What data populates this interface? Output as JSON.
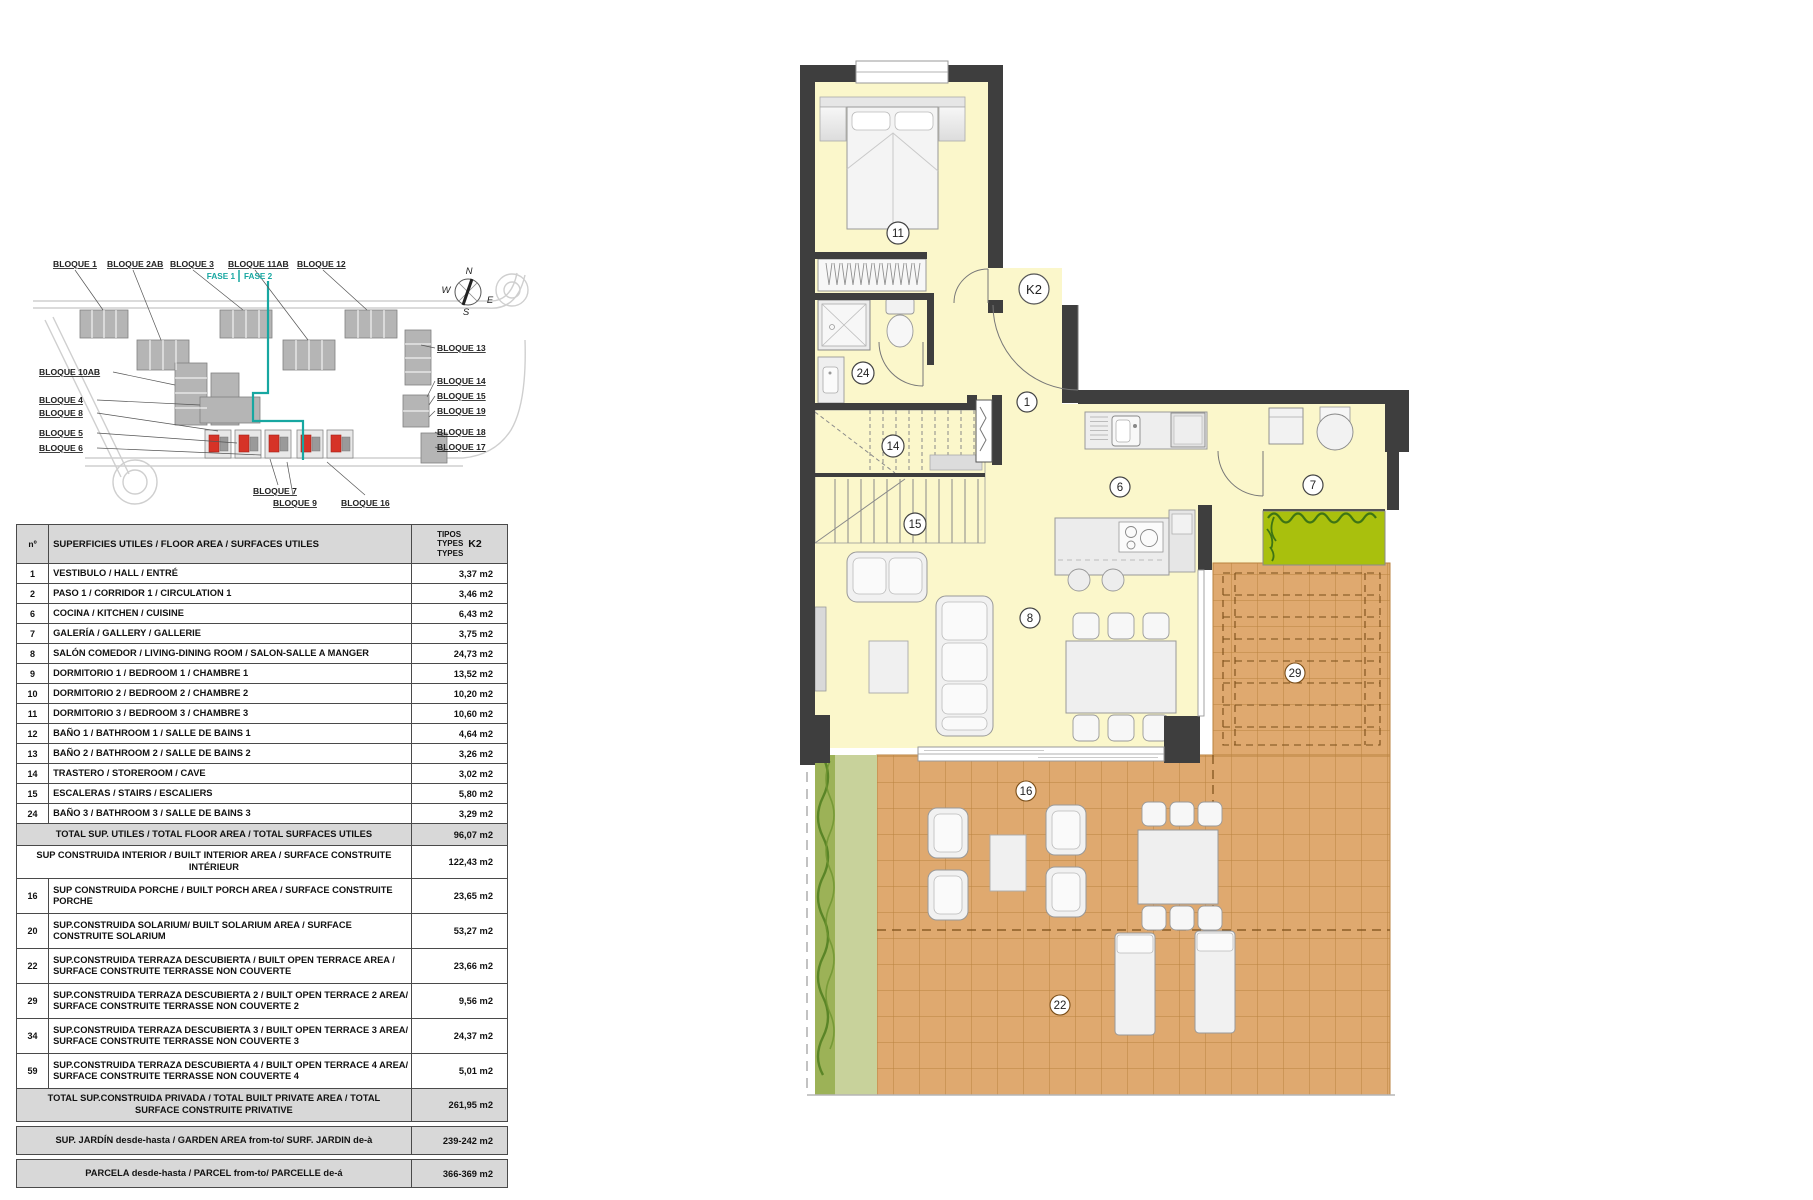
{
  "document": {
    "background": "#ffffff"
  },
  "site_plan": {
    "labels_top": [
      "BLOQUE 1",
      "BLOQUE 2AB",
      "BLOQUE 3",
      "BLOQUE 11AB",
      "BLOQUE 12"
    ],
    "fase1": "FASE 1",
    "fase2": "FASE 2",
    "labels_left": [
      "BLOQUE 10AB",
      "BLOQUE 4",
      "BLOQUE 8",
      "BLOQUE 5",
      "BLOQUE 6"
    ],
    "labels_right": [
      "BLOQUE 13",
      "BLOQUE 14",
      "BLOQUE 15",
      "BLOQUE 19",
      "BLOQUE 18",
      "BLOQUE 17"
    ],
    "labels_bottom": [
      "BLOQUE 7",
      "BLOQUE 9",
      "BLOQUE 16"
    ],
    "compass": {
      "n": "N",
      "s": "S",
      "e": "E",
      "w": "W"
    },
    "colors": {
      "phase_line": "#17a7a1",
      "highlight_unit": "#d63327",
      "building": "#b5b5b5"
    }
  },
  "area_table": {
    "header": {
      "num_col": "nº",
      "label_col": "SUPERFICIES UTILES / FLOOR AREA / SURFACES UTILES",
      "types_line1": "TIPOS",
      "types_line2": "TYPES",
      "types_line3": "TYPES",
      "type_code": "K2"
    },
    "rows": [
      {
        "num": "1",
        "label": "VESTIBULO / HALL / ENTRÉ",
        "value": "3,37 m2"
      },
      {
        "num": "2",
        "label": "PASO 1 / CORRIDOR 1 / CIRCULATION 1",
        "value": "3,46 m2"
      },
      {
        "num": "6",
        "label": "COCINA / KITCHEN / CUISINE",
        "value": "6,43 m2"
      },
      {
        "num": "7",
        "label": "GALERÍA / GALLERY / GALLERIE",
        "value": "3,75 m2"
      },
      {
        "num": "8",
        "label": "SALÓN COMEDOR  / LIVING-DINING ROOM / SALON-SALLE A MANGER",
        "value": "24,73 m2"
      },
      {
        "num": "9",
        "label": "DORMITORIO 1 / BEDROOM 1 / CHAMBRE 1",
        "value": "13,52 m2"
      },
      {
        "num": "10",
        "label": "DORMITORIO 2 / BEDROOM 2 / CHAMBRE 2",
        "value": "10,20 m2"
      },
      {
        "num": "11",
        "label": "DORMITORIO 3 / BEDROOM 3 / CHAMBRE 3",
        "value": "10,60 m2"
      },
      {
        "num": "12",
        "label": "BAÑO 1 / BATHROOM 1 / SALLE DE BAINS 1",
        "value": "4,64 m2"
      },
      {
        "num": "13",
        "label": "BAÑO 2 / BATHROOM 2 / SALLE DE BAINS 2",
        "value": "3,26 m2"
      },
      {
        "num": "14",
        "label": "TRASTERO / STOREROOM / CAVE",
        "value": "3,02 m2"
      },
      {
        "num": "15",
        "label": "ESCALERAS / STAIRS / ESCALIERS",
        "value": "5,80 m2"
      },
      {
        "num": "24",
        "label": "BAÑO 3 / BATHROOM 3 / SALLE DE BAINS 3",
        "value": "3,29 m2"
      }
    ],
    "total_utiles": {
      "label": "TOTAL  SUP. UTILES / TOTAL FLOOR AREA / TOTAL  SURFACES UTILES",
      "value": "96,07 m2"
    },
    "built_rows": [
      {
        "num": "",
        "label": "SUP CONSTRUIDA INTERIOR / BUILT INTERIOR AREA /  SURFACE CONSTRUITE INTÉRIEUR",
        "value": "122,43 m2"
      },
      {
        "num": "16",
        "label": "SUP CONSTRUIDA PORCHE  / BUILT PORCH  AREA / SURFACE CONSTRUITE PORCHE",
        "value": "23,65 m2"
      },
      {
        "num": "20",
        "label": "SUP.CONSTRUIDA SOLARIUM/ BUILT SOLARIUM AREA / SURFACE CONSTRUITE SOLARIUM",
        "value": "53,27 m2"
      },
      {
        "num": "22",
        "label": "SUP.CONSTRUIDA TERRAZA DESCUBIERTA  / BUILT OPEN TERRACE  AREA / SURFACE CONSTRUITE TERRASSE NON COUVERTE",
        "value": "23,66 m2"
      },
      {
        "num": "29",
        "label": "SUP.CONSTRUIDA TERRAZA DESCUBIERTA 2 / BUILT OPEN TERRACE 2 AREA/ SURFACE CONSTRUITE TERRASSE NON COUVERTE 2",
        "value": "9,56 m2"
      },
      {
        "num": "34",
        "label": "SUP.CONSTRUIDA TERRAZA DESCUBIERTA 3 / BUILT OPEN TERRACE 3 AREA/ SURFACE CONSTRUITE TERRASSE NON COUVERTE 3",
        "value": "24,37 m2"
      },
      {
        "num": "59",
        "label": "SUP.CONSTRUIDA TERRAZA DESCUBIERTA 4 / BUILT OPEN TERRACE 4 AREA/ SURFACE CONSTRUITE TERRASSE NON COUVERTE 4",
        "value": "5,01 m2"
      }
    ],
    "total_privada": {
      "label": "TOTAL SUP.CONSTRUIDA PRIVADA / TOTAL  BUILT PRIVATE AREA / TOTAL SURFACE CONSTRUITE PRIVATIVE",
      "value": "261,95 m2"
    },
    "jardin": {
      "label": "SUP. JARDÍN desde-hasta / GARDEN AREA  from-to/ SURF. JARDIN de-à",
      "value": "239-242 m2"
    },
    "parcela": {
      "label": "PARCELA desde-hasta / PARCEL  from-to/ PARCELLE de-á",
      "value": "366-369 m2"
    }
  },
  "floor_plan": {
    "unit_label": "K2",
    "rooms": [
      {
        "n": "11"
      },
      {
        "n": "24"
      },
      {
        "n": "14"
      },
      {
        "n": "15"
      },
      {
        "n": "1"
      },
      {
        "n": "6"
      },
      {
        "n": "7"
      },
      {
        "n": "8"
      },
      {
        "n": "16"
      },
      {
        "n": "29"
      },
      {
        "n": "22"
      }
    ],
    "colors": {
      "wall": "#3E3E3E",
      "room_fill": "#FBF7CB",
      "terrace_tile": "#DFA96F",
      "planter_green": "#A9C00D",
      "garden_green": "#C8D29B"
    }
  }
}
